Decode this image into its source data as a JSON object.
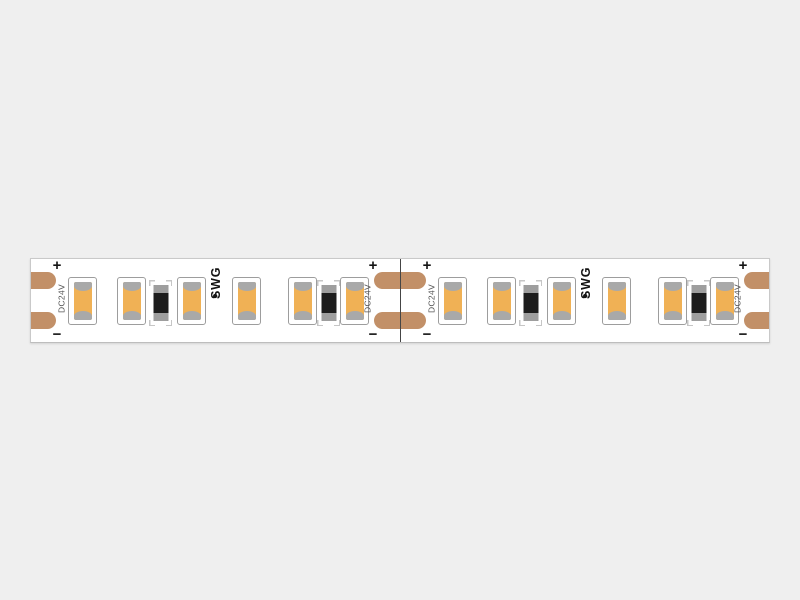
{
  "app": {
    "background_color": "#efefef",
    "description": "LED strip product image"
  },
  "strip": {
    "voltage_label": "DC24V",
    "brand_label": "SWG",
    "brand_dot": "●",
    "plus_label": "+",
    "minus_label": "−",
    "segment_count": 2,
    "leds_per_segment": 6,
    "resistors_per_segment": 2,
    "cut_points": 3,
    "colors": {
      "pcb": "#ffffff",
      "copper_pad": "#c29068",
      "led_emitter": "#f0b155",
      "led_electrode": "#a9a9a9",
      "led_outline": "#9d9d9d",
      "resistor_body": "#1d1d1d",
      "resistor_cap": "#9e9e9e",
      "bracket": "#c6c6c6",
      "strip_outline": "#c9c9c9",
      "cut_line": "#454545",
      "label_text": "#555555",
      "polarity_mark": "#141414",
      "background": "#efefef"
    }
  }
}
